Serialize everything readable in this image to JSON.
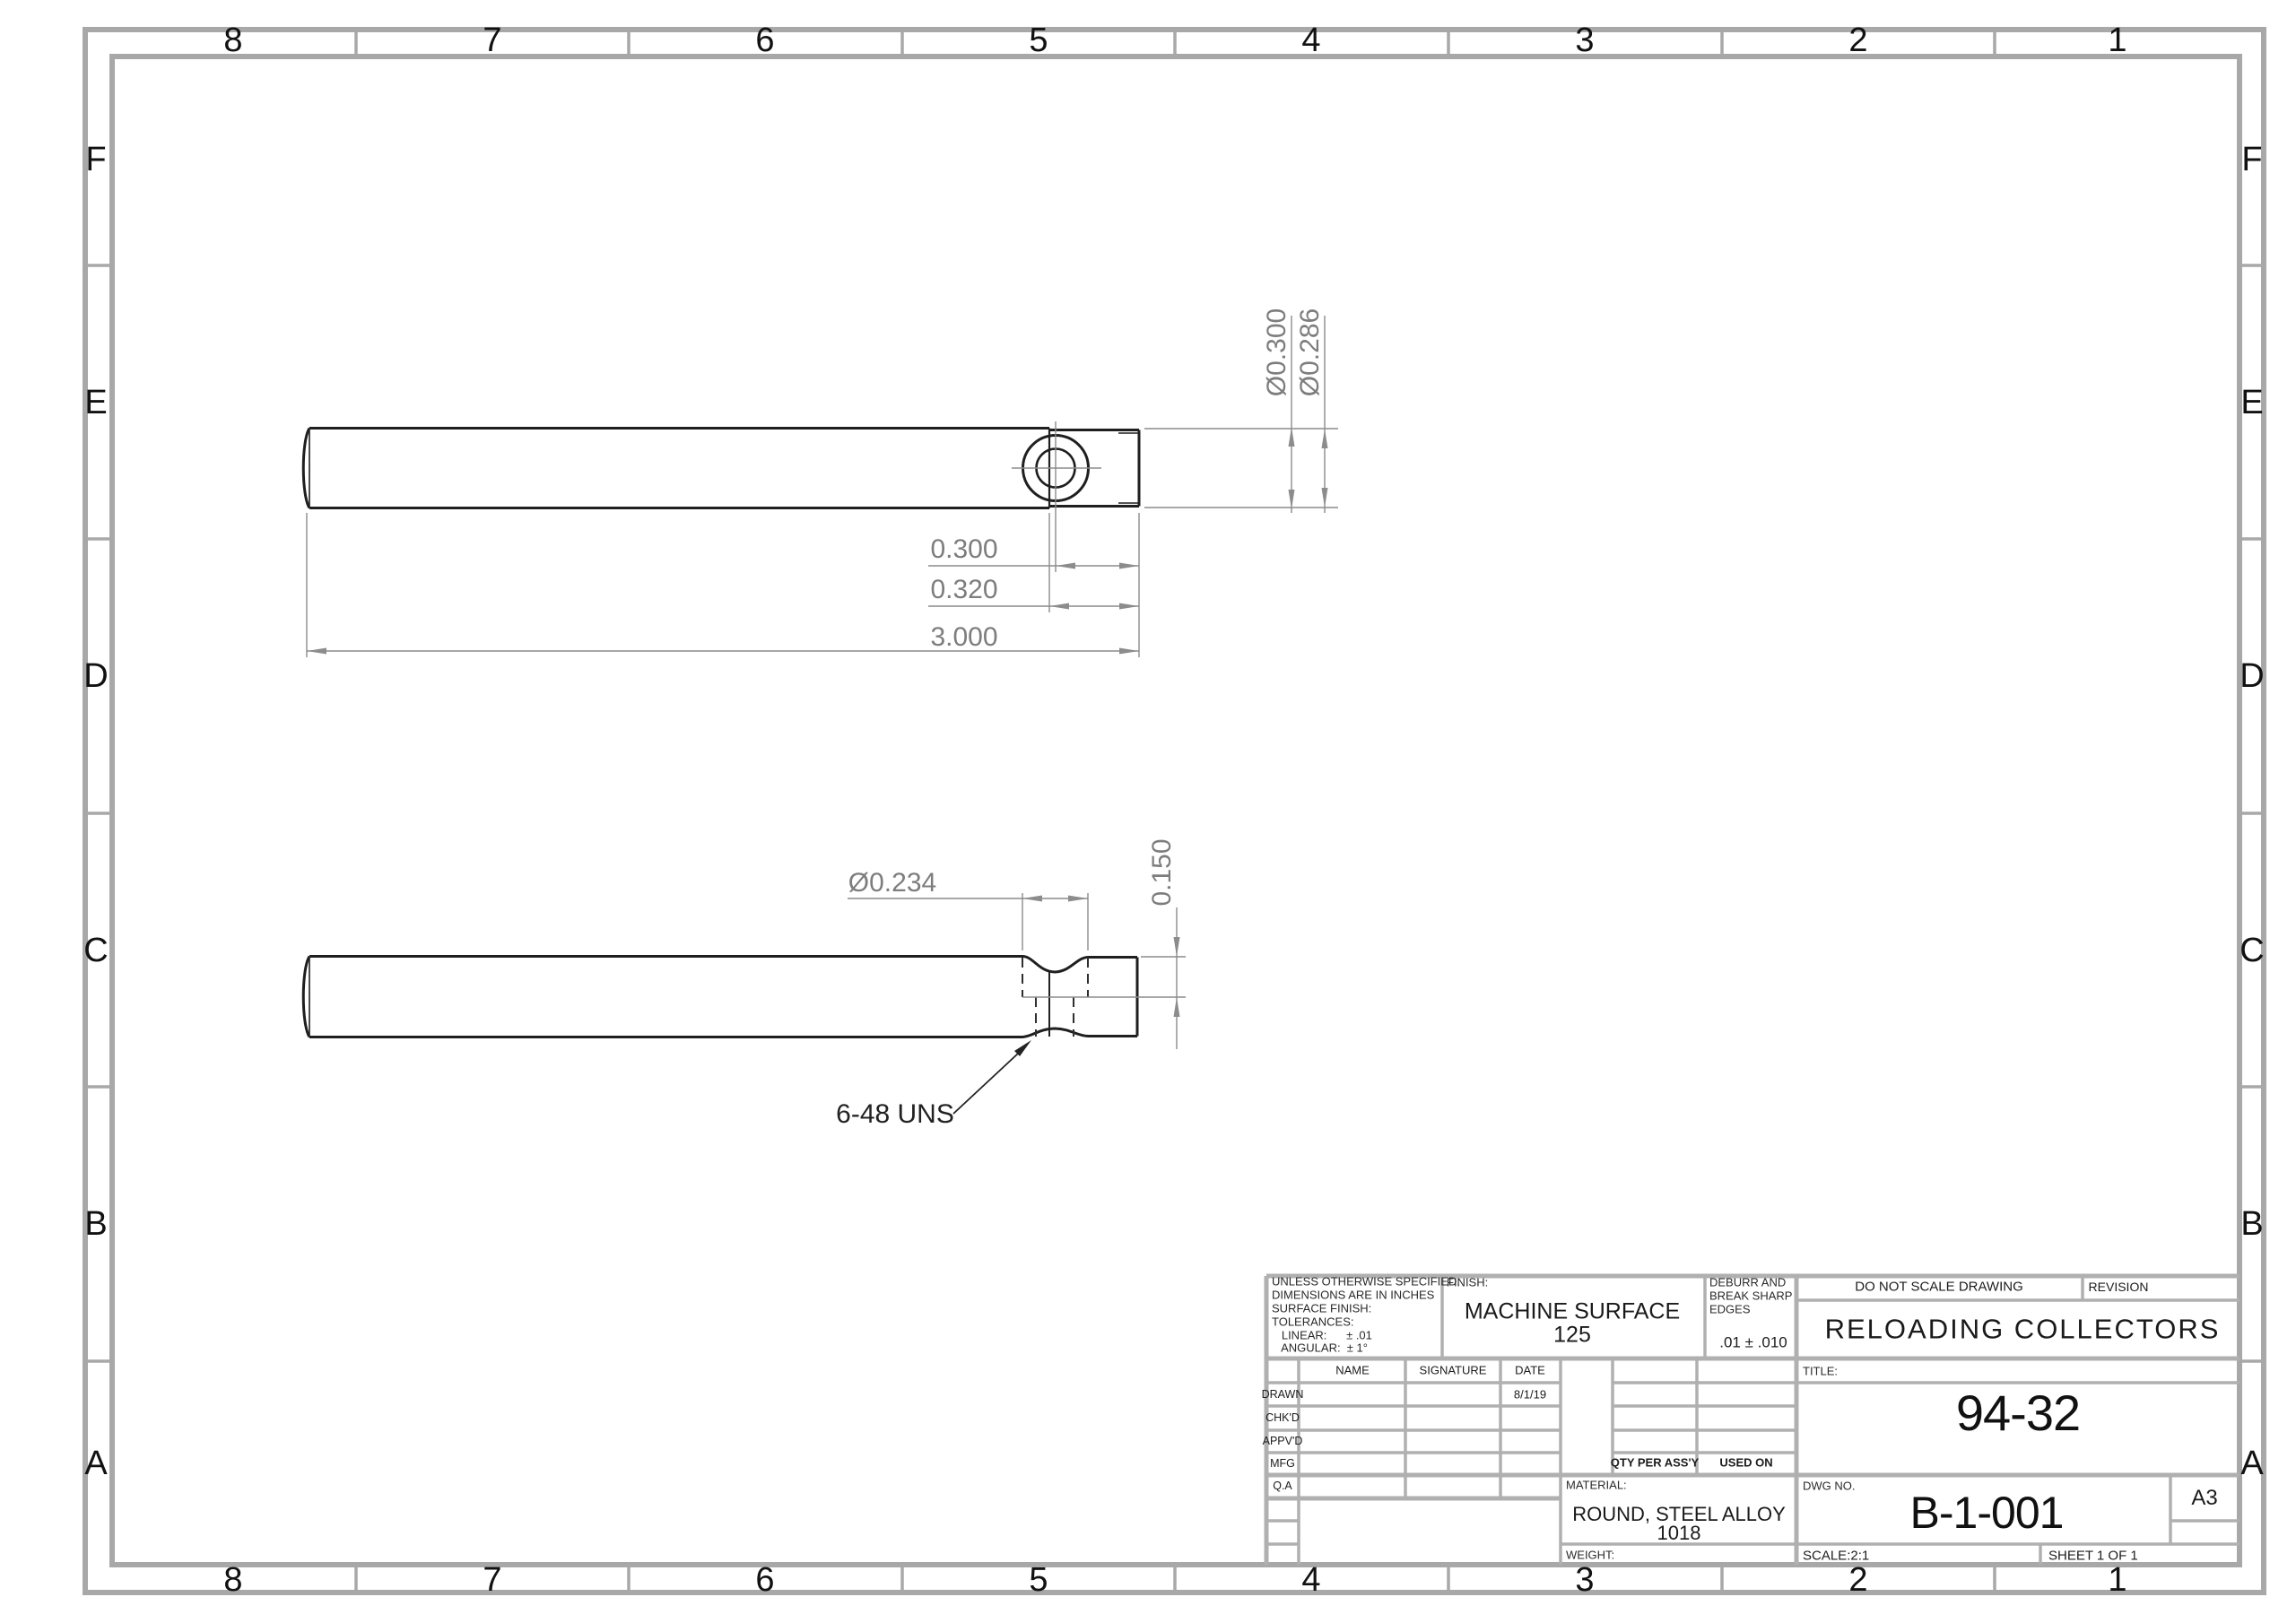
{
  "zones": {
    "top": [
      "8",
      "7",
      "6",
      "5",
      "4",
      "3",
      "2",
      "1"
    ],
    "bottom": [
      "8",
      "7",
      "6",
      "5",
      "4",
      "3",
      "2",
      "1"
    ],
    "left": [
      "F",
      "E",
      "D",
      "C",
      "B",
      "A"
    ],
    "right": [
      "F",
      "E",
      "D",
      "C",
      "B",
      "A"
    ]
  },
  "dims": {
    "hole_offset": "0.300",
    "step_length": "0.320",
    "overall_length": "3.000",
    "dia_major": "Ø0.300",
    "dia_blank": "Ø0.286",
    "dia_relief": "Ø0.234",
    "depth": "0.150",
    "thread_callout": "6-48 UNS"
  },
  "title_block": {
    "tolerance_notes": [
      "UNLESS OTHERWISE SPECIFIED:",
      "DIMENSIONS ARE IN INCHES",
      "SURFACE FINISH:",
      "TOLERANCES:",
      "   LINEAR:      ± .01",
      "   ANGULAR:  ± 1°"
    ],
    "finish_label": "FINISH:",
    "finish_line1": "MACHINE SURFACE",
    "finish_line2": "125",
    "deburr_lines": [
      "DEBURR AND",
      "BREAK SHARP",
      "EDGES"
    ],
    "deburr_value": ".01 ± .010",
    "do_not_scale": "DO NOT SCALE DRAWING",
    "revision_label": "REVISION",
    "company": "RELOADING COLLECTORS",
    "col_name": "NAME",
    "col_signature": "SIGNATURE",
    "col_date": "DATE",
    "row_labels": [
      "DRAWN",
      "CHK'D",
      "APPV'D",
      "MFG",
      "Q.A"
    ],
    "drawn_date": "8/1/19",
    "qty_per_assy": "QTY PER ASS'Y",
    "used_on": "USED ON",
    "material_label": "MATERIAL:",
    "material_line1": "ROUND, STEEL ALLOY",
    "material_line2": "1018",
    "weight_label": "WEIGHT:",
    "title_label": "TITLE:",
    "title_value": "94-32",
    "dwg_no_label": "DWG NO.",
    "dwg_no_value": "B-1-001",
    "paper_size": "A3",
    "scale_label": "SCALE:2:1",
    "sheet_label": "SHEET 1 OF 1"
  },
  "colors": {
    "border_gray": "#a8a8a8",
    "grid_gray": "#b0b0b0",
    "edge_dark": "#1f1f1f",
    "dim_gray": "#8c8c8c"
  }
}
